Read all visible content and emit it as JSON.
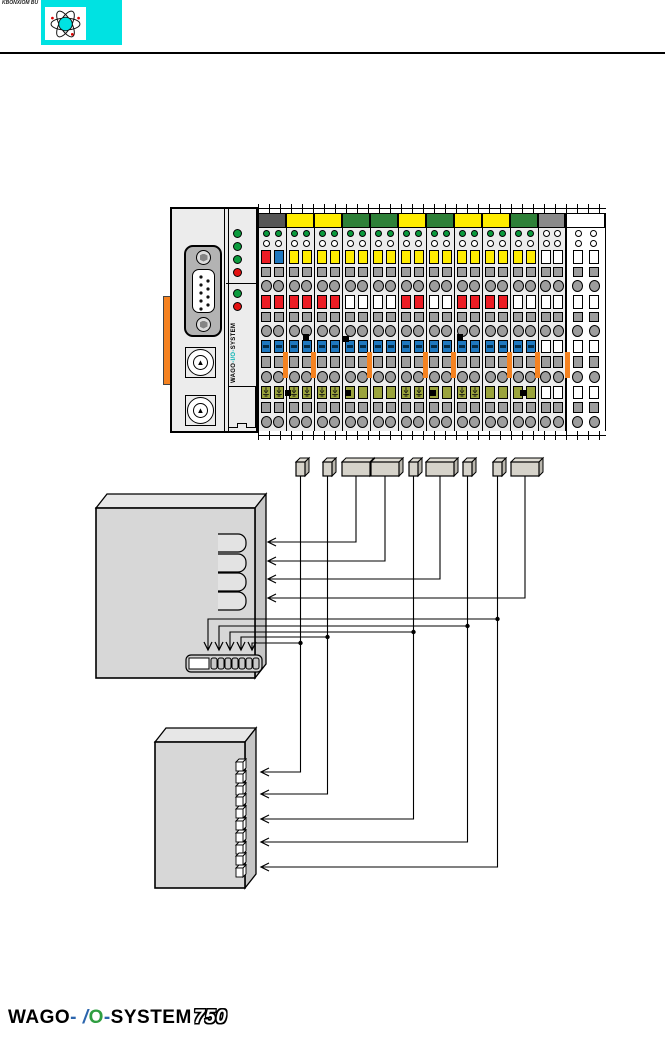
{
  "page": {
    "corner_text": "KBONXIOM BU",
    "footer": {
      "brand": "WAGO",
      "dash1": "-",
      "slash": "/",
      "io_o": "O",
      "dash2": "-",
      "system": "SYSTEM",
      "series": "750"
    }
  },
  "header": {
    "banner_color": "#00e2e2",
    "icon": "atom-icon"
  },
  "node": {
    "coupler": {
      "label": {
        "pre": "WAGO",
        "mid": "-I/O-",
        "post": "SYSTEM"
      },
      "leds_top": [
        "green",
        "green",
        "green",
        "red"
      ],
      "leds_mid": [
        "green",
        "red"
      ],
      "knob_glyph": "▲"
    },
    "colors": {
      "yellow": "#ffec00",
      "green_tab": "#2e8038",
      "dark_tab": "#565656",
      "gray_tab": "#8a8a8a",
      "red": "#ec1c24",
      "blue": "#1e78c0",
      "olive": "#9aa33c",
      "led_green": "#0a9b3d",
      "orange": "#f58220",
      "cell_gray": "#9d9d9d",
      "body": "#ececec",
      "cyan": "#00e2e2"
    },
    "modules": [
      {
        "tab": "dark",
        "a": "redblue",
        "b": "red",
        "c": "blue",
        "d": "earth",
        "led": "green"
      },
      {
        "tab": "yellow",
        "a": "yellow",
        "b": "red",
        "c": "blue",
        "d": "earth",
        "led": "green"
      },
      {
        "tab": "yellow",
        "a": "yellow",
        "b": "red",
        "c": "blue",
        "d": "earth",
        "led": "green"
      },
      {
        "tab": "green",
        "a": "yellow",
        "b": "white",
        "c": "blue",
        "d": "olive",
        "led": "green"
      },
      {
        "tab": "green",
        "a": "yellow",
        "b": "white",
        "c": "blue",
        "d": "olive",
        "led": "green"
      },
      {
        "tab": "yellow",
        "a": "yellow",
        "b": "red",
        "c": "blue",
        "d": "earth",
        "led": "green"
      },
      {
        "tab": "green",
        "a": "yellow",
        "b": "white",
        "c": "blue",
        "d": "olive",
        "led": "green"
      },
      {
        "tab": "yellow",
        "a": "yellow",
        "b": "red",
        "c": "blue",
        "d": "earth",
        "led": "green"
      },
      {
        "tab": "yellow",
        "a": "yellow",
        "b": "red",
        "c": "blue",
        "d": "olive",
        "led": "green"
      },
      {
        "tab": "green",
        "a": "yellow",
        "b": "white",
        "c": "blue",
        "d": "olive",
        "led": "green"
      },
      {
        "tab": "gray",
        "a": "white",
        "b": "white",
        "c": "white",
        "d": "white",
        "led": "white"
      },
      {
        "tab": "white",
        "a": "white",
        "b": "white",
        "c": "white",
        "d": "white",
        "led": "white",
        "ghost": true
      }
    ],
    "orange_stripes": [
      285,
      313,
      369,
      425,
      453,
      509,
      537,
      567
    ],
    "black_squares": [
      [
        303,
        334
      ],
      [
        343,
        336
      ],
      [
        457,
        334
      ],
      [
        285,
        390
      ],
      [
        345,
        390
      ],
      [
        430,
        390
      ],
      [
        520,
        390
      ]
    ]
  },
  "mapping": {
    "data_boxes": [
      {
        "x": 296,
        "w": 9,
        "type": "bit"
      },
      {
        "x": 323,
        "w": 9,
        "type": "bit"
      },
      {
        "x": 342,
        "w": 28,
        "type": "word"
      },
      {
        "x": 371,
        "w": 28,
        "type": "word"
      },
      {
        "x": 409,
        "w": 9,
        "type": "bit"
      },
      {
        "x": 426,
        "w": 28,
        "type": "word"
      },
      {
        "x": 463,
        "w": 9,
        "type": "bit"
      },
      {
        "x": 493,
        "w": 9,
        "type": "bit"
      },
      {
        "x": 511,
        "w": 28,
        "type": "word"
      }
    ],
    "word_arrows": [
      {
        "box": 2,
        "y": 542
      },
      {
        "box": 3,
        "y": 561
      },
      {
        "box": 5,
        "y": 579
      },
      {
        "box": 8,
        "y": 598
      }
    ],
    "bit_arrows": [
      {
        "box": 7,
        "branch_y": 619,
        "inner_x": 208,
        "out_y": 867
      },
      {
        "box": 6,
        "branch_y": 626,
        "inner_x": 219,
        "out_y": 842
      },
      {
        "box": 4,
        "branch_y": 632,
        "inner_x": 230,
        "out_y": 819
      },
      {
        "box": 1,
        "branch_y": 637,
        "inner_x": 241,
        "out_y": 794
      },
      {
        "box": 0,
        "branch_y": 643,
        "inner_x": 252,
        "out_y": 772
      }
    ],
    "word_box": {
      "x": 96,
      "y": 508,
      "w": 159,
      "h": 170,
      "depth": 11,
      "brackets_x": 218,
      "brackets_w": 28,
      "bracket_h": 18,
      "bracket_ys": [
        534,
        554,
        573,
        592
      ],
      "bitrow": {
        "x": 186,
        "y": 655,
        "w": 76,
        "h": 17,
        "white_w": 20,
        "cells": 7
      },
      "tip_x": 268
    },
    "bit_box": {
      "x": 155,
      "y": 742,
      "w": 90,
      "h": 146,
      "depth": 11,
      "cells": {
        "x": 236,
        "w": 7,
        "h": 9,
        "start_y": 762,
        "step": 11.8,
        "count": 10
      },
      "tip_x": 261
    }
  }
}
